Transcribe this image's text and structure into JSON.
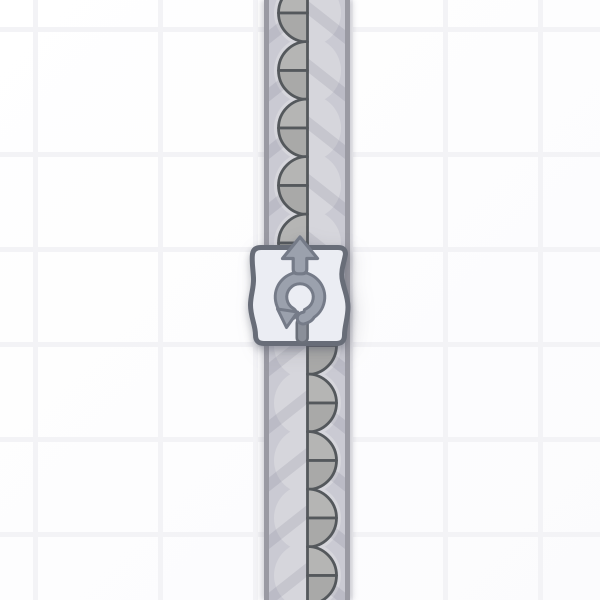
{
  "app": {
    "view": "factory-game-belt-with-rotator"
  },
  "scene": {
    "grid": {
      "cell_size": 95,
      "line_width": 5,
      "offset_x": 63,
      "offset_y": 57,
      "bg_color": "#fdfdfe",
      "line_color": "#f3f3f6"
    },
    "belt": {
      "name": "conveyor-belt",
      "direction": "up",
      "x": 264,
      "width": 86,
      "surface_color": "#cacad3",
      "border_color": "#9a9aa3",
      "chevron_overlay_color": "rgba(92,94,114,0.13)",
      "item_center_x": 307.5,
      "item_spacing": 57.5,
      "items": [
        {
          "y": 13,
          "shape": "half-circle-left"
        },
        {
          "y": 70.5,
          "shape": "half-circle-left"
        },
        {
          "y": 128,
          "shape": "half-circle-left"
        },
        {
          "y": 185.5,
          "shape": "half-circle-left"
        },
        {
          "y": 243,
          "shape": "half-circle-left"
        },
        {
          "y": 345.5,
          "shape": "half-circle-right"
        },
        {
          "y": 403,
          "shape": "half-circle-right"
        },
        {
          "y": 460.5,
          "shape": "half-circle-right"
        },
        {
          "y": 518,
          "shape": "half-circle-right"
        },
        {
          "y": 575.5,
          "shape": "half-circle-right"
        }
      ],
      "item_style": {
        "disc_radius": 33.5,
        "disc_color": "#d6d6dc",
        "shape_radius": 29,
        "quarter_fill_top": "#b5b5b4",
        "quarter_fill_bottom": "#a9a9a8",
        "outline_color": "#54585c",
        "outline_width": 2.8
      }
    },
    "building": {
      "name": "rotator",
      "output_direction": "up",
      "tile": {
        "x": 250.5,
        "y": 245,
        "w": 99,
        "h": 101
      },
      "fill": "#ebedf3",
      "border_color": "#686d78",
      "border_width": 5,
      "icon_fill": "#9ba1ad",
      "icon_outline": "#757b88",
      "notch_fill": "#8a8f99",
      "notch_outline": "#6a6f79",
      "icons": [
        "up-arrow-icon",
        "rotate-arrow-icon",
        "input-notch"
      ]
    }
  }
}
